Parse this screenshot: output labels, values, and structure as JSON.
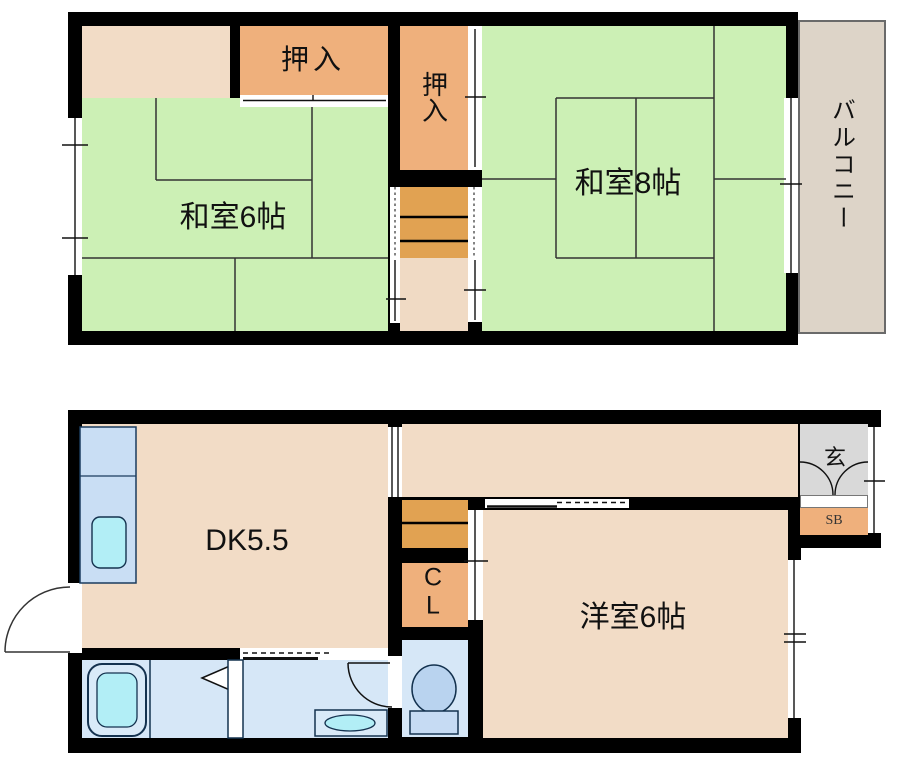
{
  "colors": {
    "wall": "#000000",
    "tatami_green": "#ccf0b5",
    "room_peach": "#f2dcc6",
    "closet_orange": "#efb07c",
    "stair_orange": "#e1a252",
    "landing_peach": "#f0dac4",
    "balcony_beige": "#ddd4c8",
    "entrance_gray": "#d9d9d9",
    "wet_blue": "#d6e7f7",
    "counter_blue": "#c9def4",
    "fixture_cyan": "#b2eef6",
    "toilet_blue": "#b9d3ef"
  },
  "floor2": {
    "japanese_room_6": "和室6帖",
    "japanese_room_8": "和室8帖",
    "closet_top": "押入",
    "closet_mid": "押入",
    "balcony": "バルコニー"
  },
  "floor1": {
    "dining_kitchen": "DK5.5",
    "western_room": "洋室6帖",
    "closet_line1": "C",
    "closet_line2": "L",
    "entrance": "玄",
    "shoe_box": "SB"
  }
}
